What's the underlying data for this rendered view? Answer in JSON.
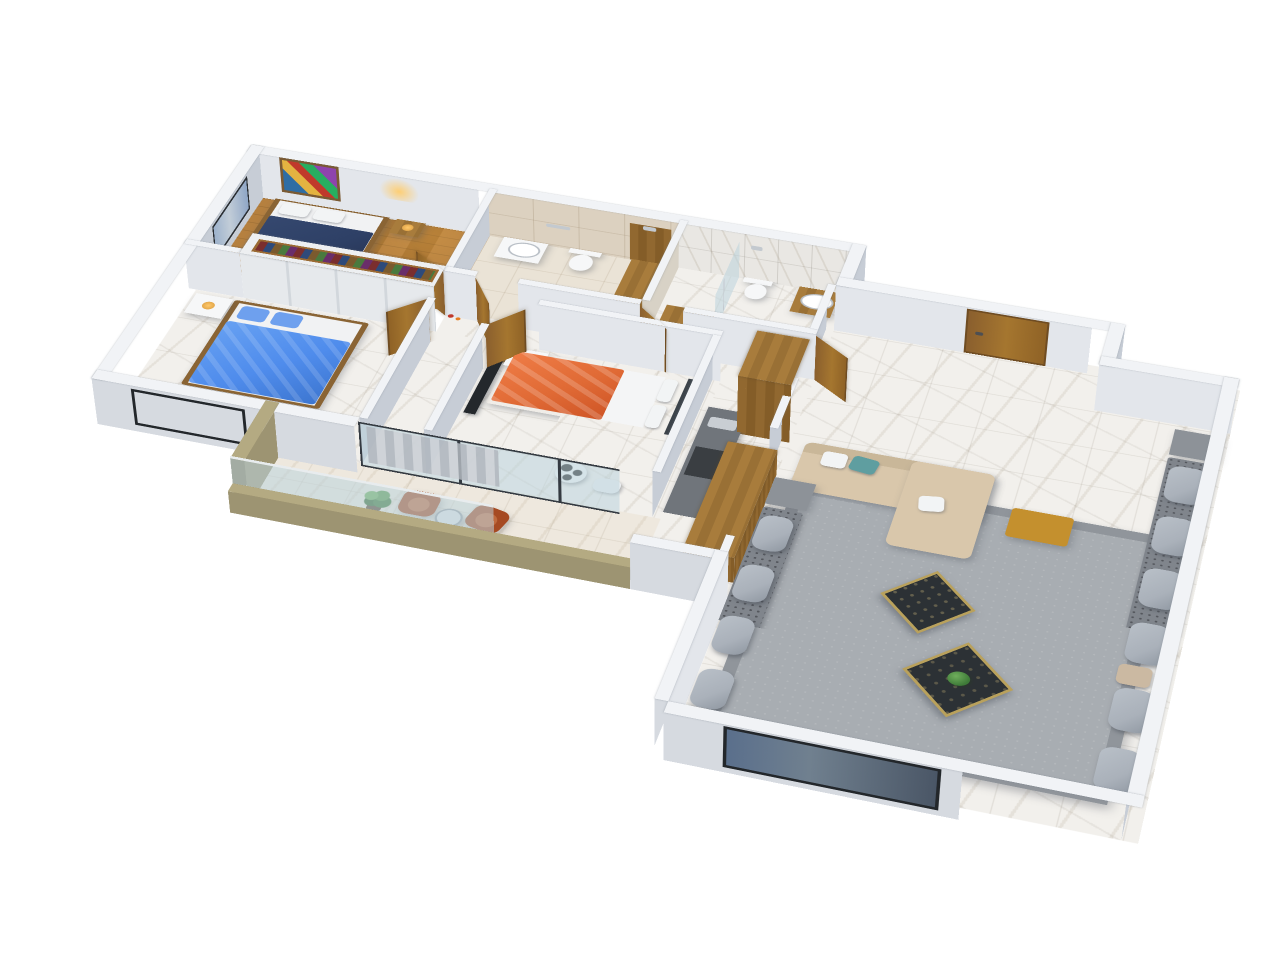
{
  "scene": {
    "background": "#ffffff",
    "projection": "isometric-3d-floorplan",
    "text_labels": "none"
  },
  "palette": {
    "wall-top": "#f1f3f6",
    "wall-h": "#e3e6eb",
    "wall-v": "#c7cdd6",
    "wall-outer": "#d6dae0",
    "tile-beige-wall": "#dcd1c0",
    "tile-beige-floor": "#eae3d6",
    "marble": "#f2f0ec",
    "marble-warm": "#eee8de",
    "wood-floor": "#ae7b3d",
    "door-wood": "#96672f",
    "olive": "#9d9472",
    "olive-dark": "#857c5c",
    "olive-top": "#b4aa82",
    "glass": "rgba(188,212,220,0.55)",
    "glass-frame": "#343a41",
    "rug": "#a8adb2",
    "rug-border": "#90959b",
    "sofa": "#d9c7ab",
    "cushion": "#aab1ba",
    "cushion-base": "#80858c",
    "navy": "#2e4066",
    "blue": "#4f8cec",
    "orange": "#e06a35",
    "teal": "#5f9ea0",
    "rust": "#a64a22",
    "mustard": "#c4902e",
    "table-dark": "#2c3135",
    "tv-dark": "#24282c",
    "headboard": "#3c434a",
    "white-soft": "#f6f7f8",
    "plant": "#3e7a38",
    "gray-counter": "#70757b",
    "amber": "#ffc96b",
    "steel": "#c3c9cf"
  },
  "rooms": [
    {
      "id": "bedroom-1",
      "label": "Bedroom 1",
      "floor": "wood",
      "furniture": [
        "double-bed-navy",
        "wardrobe-with-clothes",
        "wall-art",
        "wall-lamp",
        "nightstand"
      ]
    },
    {
      "id": "bathroom-1",
      "label": "Bathroom 1",
      "floor": "beige-tile",
      "furniture": [
        "vanity-sink",
        "toilet",
        "wood-shower",
        "towel-bar",
        "glass-divider"
      ]
    },
    {
      "id": "bathroom-2",
      "label": "Bathroom 2",
      "floor": "marble",
      "furniture": [
        "glass-shower",
        "toilet",
        "wood-vanity-sink"
      ]
    },
    {
      "id": "bedroom-2",
      "label": "Bedroom 2",
      "floor": "marble",
      "furniture": [
        "double-bed-blue",
        "nightstand-lamp",
        "window"
      ]
    },
    {
      "id": "bedroom-3",
      "label": "Bedroom 3",
      "floor": "marble",
      "furniture": [
        "double-bed-orange",
        "tv-unit",
        "dome-lamp-table",
        "ball-pouf",
        "sliding-glass-door"
      ]
    },
    {
      "id": "hallway",
      "label": "Hallway",
      "floor": "marble",
      "furniture": [
        "open-wood-doors",
        "deco-bottles"
      ]
    },
    {
      "id": "kitchen-corridor",
      "label": "Kitchen corridor",
      "floor": "marble",
      "furniture": [
        "tall-wood-cabinet",
        "wood-counter",
        "gray-counter-stove"
      ]
    },
    {
      "id": "entry",
      "label": "Entry hall",
      "floor": "marble",
      "furniture": [
        "front-door-closed"
      ]
    },
    {
      "id": "living-room",
      "label": "Living room",
      "floor": "marble",
      "furniture": [
        "beige-sofa-chaise",
        "mustard-ottoman",
        "area-rug",
        "majlis-cushions-right",
        "majlis-cushions-left",
        "coffee-table-dark-1",
        "coffee-table-dark-2",
        "side-table-gray-1",
        "side-table-gray-2",
        "window-south"
      ]
    },
    {
      "id": "balcony",
      "label": "Balcony",
      "floor": "marble",
      "furniture": [
        "armchair-rust-1",
        "armchair-rust-2",
        "round-table",
        "potted-plant",
        "glass-railing",
        "olive-parapet"
      ]
    }
  ],
  "counts": {
    "bedrooms": 3,
    "bathrooms": 2,
    "open-doors": 6,
    "windows": 4,
    "balconies": 1
  }
}
